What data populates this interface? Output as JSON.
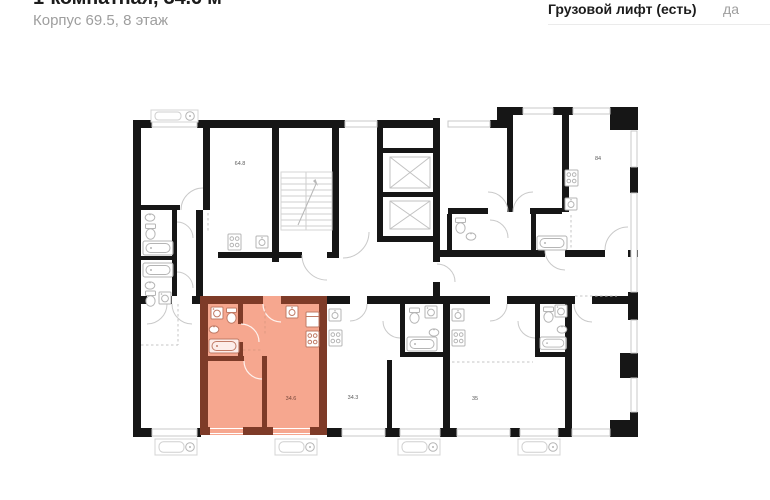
{
  "header": {
    "title": "1-комнатная, 34.6 м²",
    "subtitle": "Корпус 69.5, 8 этаж",
    "info": {
      "label": "Грузовой лифт (есть)",
      "value": "да"
    }
  },
  "plan": {
    "labels": {
      "apt_648": "64.8",
      "apt_84": "84",
      "apt_346": "34.6",
      "apt_343": "34.3",
      "apt_35": "35"
    }
  },
  "colors": {
    "highlight_fill": "#F6A78F",
    "highlight_wall": "#7E3B28",
    "highlight_fixture": "#C07B66",
    "wall": "#161616",
    "fixture": "#B5B5B5",
    "title_text": "#1C1C1C",
    "muted_text": "#9E9E9E",
    "divider": "#EBEBEB"
  }
}
